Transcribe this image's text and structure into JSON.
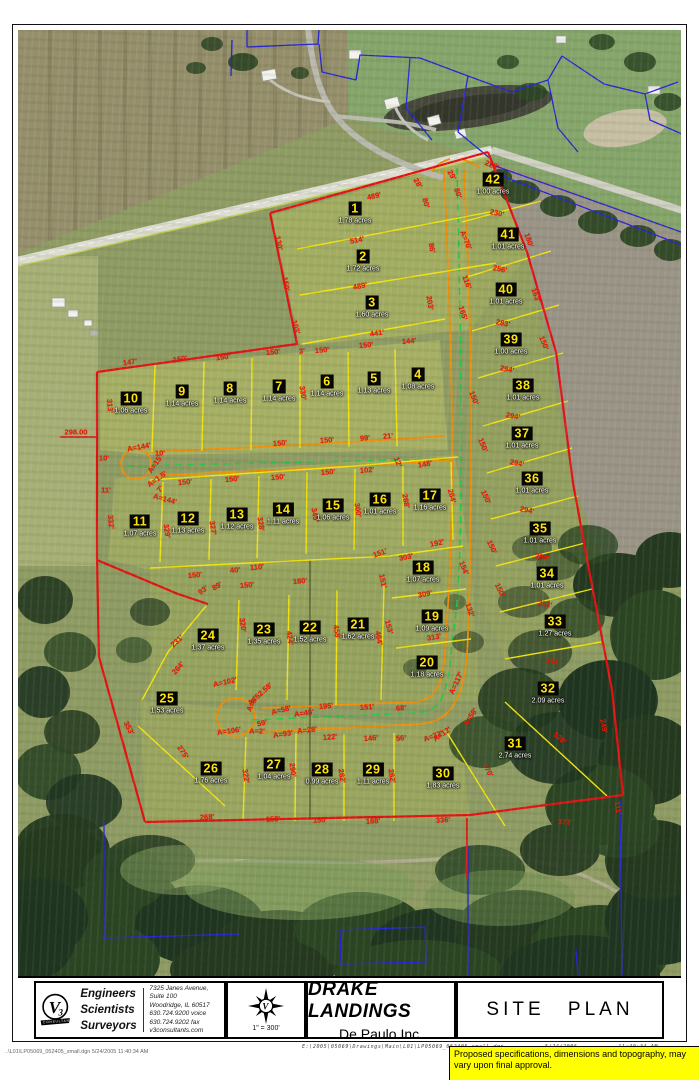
{
  "title_block": {
    "logo": {
      "letter": "V",
      "digit": "3",
      "banner": "CONSULTANTS"
    },
    "firm": {
      "roles": [
        "Engineers",
        "Scientists",
        "Surveyors"
      ],
      "address": [
        "7325 Janes Avenue, Suite 100",
        "Woodridge, IL 60517",
        "630.724.9200 voice",
        "630.724.9202 fax",
        "v3consultants.com"
      ]
    },
    "scale": "1\" = 300'",
    "project": "DRAKE LANDINGS",
    "client": "De Paulo Inc.",
    "sheet": "SITE PLAN",
    "file_path": "E:\\2005\\05069\\Drawings\\Main\\L01\\LP05069_052405_small.dgn",
    "date": "5/24/2005",
    "time": "11:40:34 AM"
  },
  "footer": {
    "left": "..\\L01\\LP05069_052405_small.dgn  5/24/2005 11:40:34 AM"
  },
  "note": {
    "text": "Proposed specifications, dimensions and topography, may vary upon final approval."
  },
  "map": {
    "colors": {
      "boundary": "#e51212",
      "lot_line": "#f2e30e",
      "street_edge": "#ef8f0a",
      "centerline": "#28c54a",
      "parcel_line": "#2626d8",
      "lot_badge_bg": "#050505",
      "lot_badge_fg": "#ffe40a",
      "dimension_text": "#ee1605",
      "note_bg": "#ffff00"
    },
    "lots": [
      {
        "n": 1,
        "acres": "1.78 acres",
        "x": 355,
        "y": 212
      },
      {
        "n": 2,
        "acres": "1.72 acres",
        "x": 363,
        "y": 260
      },
      {
        "n": 3,
        "acres": "1.60 acres",
        "x": 372,
        "y": 306
      },
      {
        "n": 4,
        "acres": "1.08 acres",
        "x": 418,
        "y": 378
      },
      {
        "n": 5,
        "acres": "1.13 acres",
        "x": 374,
        "y": 382
      },
      {
        "n": 6,
        "acres": "1.14 acres",
        "x": 327,
        "y": 385
      },
      {
        "n": 7,
        "acres": "1.14 acres",
        "x": 279,
        "y": 390
      },
      {
        "n": 8,
        "acres": "1.14 acres",
        "x": 230,
        "y": 392
      },
      {
        "n": 9,
        "acres": "1.14 acres",
        "x": 182,
        "y": 395
      },
      {
        "n": 10,
        "acres": "1.06 acres",
        "x": 131,
        "y": 402
      },
      {
        "n": 11,
        "acres": "1.07 acres",
        "x": 140,
        "y": 525
      },
      {
        "n": 12,
        "acres": "1.13 acres",
        "x": 188,
        "y": 522
      },
      {
        "n": 13,
        "acres": "1.12 acres",
        "x": 237,
        "y": 518
      },
      {
        "n": 14,
        "acres": "1.11 acres",
        "x": 283,
        "y": 513
      },
      {
        "n": 15,
        "acres": "1.06 acres",
        "x": 333,
        "y": 509
      },
      {
        "n": 16,
        "acres": "1.01 acres",
        "x": 380,
        "y": 503
      },
      {
        "n": 17,
        "acres": "1.16 acres",
        "x": 430,
        "y": 499
      },
      {
        "n": 18,
        "acres": "1.07 acres",
        "x": 423,
        "y": 571
      },
      {
        "n": 19,
        "acres": "1.09 acres",
        "x": 432,
        "y": 620
      },
      {
        "n": 20,
        "acres": "1.18 acres",
        "x": 427,
        "y": 666
      },
      {
        "n": 21,
        "acres": "1.62 acres",
        "x": 358,
        "y": 628
      },
      {
        "n": 22,
        "acres": "1.52 acres",
        "x": 310,
        "y": 631
      },
      {
        "n": 23,
        "acres": "1.35 acres",
        "x": 264,
        "y": 633
      },
      {
        "n": 24,
        "acres": "1.37 acres",
        "x": 208,
        "y": 639
      },
      {
        "n": 25,
        "acres": "1.53 acres",
        "x": 167,
        "y": 702
      },
      {
        "n": 26,
        "acres": "1.76 acres",
        "x": 211,
        "y": 772
      },
      {
        "n": 27,
        "acres": "1.04 acres",
        "x": 274,
        "y": 768
      },
      {
        "n": 28,
        "acres": "0.99 acres",
        "x": 322,
        "y": 773
      },
      {
        "n": 29,
        "acres": "1.11 acres",
        "x": 373,
        "y": 773
      },
      {
        "n": 30,
        "acres": "1.83 acres",
        "x": 443,
        "y": 777
      },
      {
        "n": 31,
        "acres": "2.74 acres",
        "x": 515,
        "y": 747
      },
      {
        "n": 32,
        "acres": "2.09 acres",
        "x": 548,
        "y": 692
      },
      {
        "n": 33,
        "acres": "1.27 acres",
        "x": 555,
        "y": 625
      },
      {
        "n": 34,
        "acres": "1.01 acres",
        "x": 547,
        "y": 577
      },
      {
        "n": 35,
        "acres": "1.01 acres",
        "x": 540,
        "y": 532
      },
      {
        "n": 36,
        "acres": "1.01 acres",
        "x": 532,
        "y": 482
      },
      {
        "n": 37,
        "acres": "1.01 acres",
        "x": 522,
        "y": 437
      },
      {
        "n": 38,
        "acres": "1.01 acres",
        "x": 523,
        "y": 389
      },
      {
        "n": 39,
        "acres": "1.00 acres",
        "x": 511,
        "y": 343
      },
      {
        "n": 40,
        "acres": "1.01 acres",
        "x": 506,
        "y": 293
      },
      {
        "n": 41,
        "acres": "1.01 acres",
        "x": 508,
        "y": 238
      },
      {
        "n": 42,
        "acres": "1.00 acres",
        "x": 493,
        "y": 183
      }
    ],
    "dimensions": [
      {
        "t": "489'",
        "x": 374,
        "y": 196,
        "r": -13
      },
      {
        "t": "514'",
        "x": 357,
        "y": 240,
        "r": -11
      },
      {
        "t": "489'",
        "x": 360,
        "y": 286,
        "r": -10
      },
      {
        "t": "441'",
        "x": 377,
        "y": 333,
        "r": -8
      },
      {
        "t": "228'",
        "x": 492,
        "y": 165,
        "r": 22
      },
      {
        "t": "230'",
        "x": 497,
        "y": 213,
        "r": 12
      },
      {
        "t": "256'",
        "x": 500,
        "y": 269,
        "r": 12
      },
      {
        "t": "283'",
        "x": 503,
        "y": 323,
        "r": 12
      },
      {
        "t": "28'",
        "x": 418,
        "y": 183,
        "r": 60
      },
      {
        "t": "80'",
        "x": 426,
        "y": 203,
        "r": 75
      },
      {
        "t": "29'",
        "x": 452,
        "y": 175,
        "r": 60
      },
      {
        "t": "80'",
        "x": 458,
        "y": 193,
        "r": 72
      },
      {
        "t": "130'",
        "x": 279,
        "y": 243,
        "r": 80
      },
      {
        "t": "150'",
        "x": 286,
        "y": 284,
        "r": 80
      },
      {
        "t": "103'",
        "x": 296,
        "y": 327,
        "r": 75
      },
      {
        "t": "86'",
        "x": 432,
        "y": 248,
        "r": 80
      },
      {
        "t": "203'",
        "x": 430,
        "y": 303,
        "r": 82
      },
      {
        "t": "A=70'",
        "x": 466,
        "y": 240,
        "r": 68
      },
      {
        "t": "116'",
        "x": 467,
        "y": 282,
        "r": 70
      },
      {
        "t": "165'",
        "x": 463,
        "y": 313,
        "r": 73
      },
      {
        "t": "180'",
        "x": 529,
        "y": 240,
        "r": 72
      },
      {
        "t": "163'",
        "x": 536,
        "y": 295,
        "r": 70
      },
      {
        "t": "150'",
        "x": 544,
        "y": 343,
        "r": 68
      },
      {
        "t": "147'",
        "x": 130,
        "y": 362,
        "r": -8
      },
      {
        "t": "150'",
        "x": 180,
        "y": 359,
        "r": -8
      },
      {
        "t": "150'",
        "x": 223,
        "y": 357,
        "r": -7
      },
      {
        "t": "150'",
        "x": 273,
        "y": 352,
        "r": -5
      },
      {
        "t": "3'",
        "x": 302,
        "y": 351,
        "r": -5
      },
      {
        "t": "150'",
        "x": 322,
        "y": 350,
        "r": -4
      },
      {
        "t": "150'",
        "x": 366,
        "y": 345,
        "r": -4
      },
      {
        "t": "144'",
        "x": 409,
        "y": 341,
        "r": -4
      },
      {
        "t": "330'",
        "x": 303,
        "y": 393,
        "r": 82
      },
      {
        "t": "298.00",
        "x": 76,
        "y": 432,
        "r": 0
      },
      {
        "t": "313'",
        "x": 110,
        "y": 406,
        "r": 85
      },
      {
        "t": "332'",
        "x": 111,
        "y": 522,
        "r": 85
      },
      {
        "t": "10'",
        "x": 104,
        "y": 458,
        "r": 0
      },
      {
        "t": "11'",
        "x": 106,
        "y": 490,
        "r": 0
      },
      {
        "t": "A=144'",
        "x": 139,
        "y": 447,
        "r": -10
      },
      {
        "t": "10'",
        "x": 160,
        "y": 453,
        "r": 0
      },
      {
        "t": "A=15'",
        "x": 155,
        "y": 464,
        "r": -55
      },
      {
        "t": "A=1.5'",
        "x": 157,
        "y": 479,
        "r": -35
      },
      {
        "t": "7'",
        "x": 160,
        "y": 489,
        "r": -50
      },
      {
        "t": "A=144'",
        "x": 165,
        "y": 499,
        "r": 15
      },
      {
        "t": "150'",
        "x": 280,
        "y": 443,
        "r": -4
      },
      {
        "t": "150'",
        "x": 327,
        "y": 440,
        "r": -4
      },
      {
        "t": "99'",
        "x": 365,
        "y": 438,
        "r": -4
      },
      {
        "t": "21'",
        "x": 388,
        "y": 436,
        "r": -4
      },
      {
        "t": "12'",
        "x": 398,
        "y": 462,
        "r": 70
      },
      {
        "t": "150'",
        "x": 185,
        "y": 482,
        "r": -5
      },
      {
        "t": "150'",
        "x": 232,
        "y": 479,
        "r": -5
      },
      {
        "t": "150'",
        "x": 278,
        "y": 477,
        "r": -4
      },
      {
        "t": "150'",
        "x": 328,
        "y": 472,
        "r": -4
      },
      {
        "t": "102'",
        "x": 367,
        "y": 470,
        "r": -4
      },
      {
        "t": "148'",
        "x": 425,
        "y": 464,
        "r": -10
      },
      {
        "t": "329'",
        "x": 167,
        "y": 531,
        "r": 82
      },
      {
        "t": "327'",
        "x": 213,
        "y": 528,
        "r": 82
      },
      {
        "t": "328'",
        "x": 261,
        "y": 524,
        "r": 82
      },
      {
        "t": "345'",
        "x": 315,
        "y": 515,
        "r": 82
      },
      {
        "t": "300'",
        "x": 358,
        "y": 510,
        "r": 82
      },
      {
        "t": "288'",
        "x": 406,
        "y": 501,
        "r": 80
      },
      {
        "t": "264'",
        "x": 452,
        "y": 496,
        "r": 75
      },
      {
        "t": "150'",
        "x": 195,
        "y": 575,
        "r": -5
      },
      {
        "t": "40'",
        "x": 235,
        "y": 570,
        "r": -5
      },
      {
        "t": "110'",
        "x": 257,
        "y": 567,
        "r": -5
      },
      {
        "t": "150'",
        "x": 247,
        "y": 585,
        "r": -5
      },
      {
        "t": "180'",
        "x": 300,
        "y": 581,
        "r": -5
      },
      {
        "t": "151'",
        "x": 380,
        "y": 553,
        "r": -20
      },
      {
        "t": "303'",
        "x": 406,
        "y": 557,
        "r": -12
      },
      {
        "t": "192'",
        "x": 437,
        "y": 543,
        "r": -12
      },
      {
        "t": "151'",
        "x": 383,
        "y": 581,
        "r": 78
      },
      {
        "t": "309'",
        "x": 425,
        "y": 594,
        "r": -10
      },
      {
        "t": "153'",
        "x": 389,
        "y": 627,
        "r": 75
      },
      {
        "t": "313'",
        "x": 434,
        "y": 637,
        "r": -10
      },
      {
        "t": "154'",
        "x": 464,
        "y": 568,
        "r": 68
      },
      {
        "t": "132'",
        "x": 470,
        "y": 610,
        "r": 72
      },
      {
        "t": "150'",
        "x": 492,
        "y": 547,
        "r": 65
      },
      {
        "t": "294'",
        "x": 507,
        "y": 369,
        "r": 11
      },
      {
        "t": "294'",
        "x": 513,
        "y": 416,
        "r": 11
      },
      {
        "t": "294'",
        "x": 517,
        "y": 463,
        "r": 11
      },
      {
        "t": "294'",
        "x": 527,
        "y": 510,
        "r": 11
      },
      {
        "t": "294'",
        "x": 542,
        "y": 557,
        "r": 11
      },
      {
        "t": "294'",
        "x": 545,
        "y": 604,
        "r": 11
      },
      {
        "t": "344'",
        "x": 553,
        "y": 661,
        "r": 11
      },
      {
        "t": "150'",
        "x": 474,
        "y": 398,
        "r": 68
      },
      {
        "t": "150'",
        "x": 483,
        "y": 445,
        "r": 68
      },
      {
        "t": "150'",
        "x": 486,
        "y": 497,
        "r": 66
      },
      {
        "t": "150'",
        "x": 500,
        "y": 590,
        "r": 64
      },
      {
        "t": "320'",
        "x": 243,
        "y": 625,
        "r": 82
      },
      {
        "t": "424'",
        "x": 290,
        "y": 638,
        "r": 82
      },
      {
        "t": "458'",
        "x": 337,
        "y": 632,
        "r": 82
      },
      {
        "t": "464'",
        "x": 379,
        "y": 638,
        "r": 80
      },
      {
        "t": "89'",
        "x": 217,
        "y": 586,
        "r": -30
      },
      {
        "t": "93'",
        "x": 203,
        "y": 590,
        "r": -35
      },
      {
        "t": "231'",
        "x": 177,
        "y": 641,
        "r": -42
      },
      {
        "t": "264'",
        "x": 178,
        "y": 668,
        "r": -48
      },
      {
        "t": "A=102'",
        "x": 225,
        "y": 682,
        "r": -12
      },
      {
        "t": "A=52.59'",
        "x": 260,
        "y": 694,
        "r": -42
      },
      {
        "t": "A=5'",
        "x": 252,
        "y": 704,
        "r": -62
      },
      {
        "t": "A=58'",
        "x": 281,
        "y": 710,
        "r": -14
      },
      {
        "t": "A=46'",
        "x": 304,
        "y": 713,
        "r": -8
      },
      {
        "t": "195'",
        "x": 326,
        "y": 706,
        "r": -5
      },
      {
        "t": "151'",
        "x": 367,
        "y": 707,
        "r": -4
      },
      {
        "t": "68'",
        "x": 401,
        "y": 708,
        "r": -4
      },
      {
        "t": "59'",
        "x": 262,
        "y": 723,
        "r": -10
      },
      {
        "t": "A=106'",
        "x": 229,
        "y": 731,
        "r": -8
      },
      {
        "t": "A=2'",
        "x": 257,
        "y": 731,
        "r": 0
      },
      {
        "t": "A=93'",
        "x": 283,
        "y": 734,
        "r": -8
      },
      {
        "t": "A=28'",
        "x": 307,
        "y": 730,
        "r": -6
      },
      {
        "t": "122'",
        "x": 330,
        "y": 737,
        "r": -4
      },
      {
        "t": "146'",
        "x": 371,
        "y": 738,
        "r": -4
      },
      {
        "t": "56'",
        "x": 401,
        "y": 738,
        "r": -4
      },
      {
        "t": "A=12'",
        "x": 442,
        "y": 734,
        "r": -35
      },
      {
        "t": "353'",
        "x": 129,
        "y": 728,
        "r": 63
      },
      {
        "t": "275'",
        "x": 183,
        "y": 752,
        "r": 56
      },
      {
        "t": "322'",
        "x": 246,
        "y": 776,
        "r": 82
      },
      {
        "t": "290'",
        "x": 293,
        "y": 770,
        "r": 82
      },
      {
        "t": "282'",
        "x": 342,
        "y": 776,
        "r": 82
      },
      {
        "t": "282'",
        "x": 392,
        "y": 776,
        "r": 82
      },
      {
        "t": "268'",
        "x": 207,
        "y": 817,
        "r": -3
      },
      {
        "t": "150'",
        "x": 273,
        "y": 819,
        "r": -3
      },
      {
        "t": "150'",
        "x": 320,
        "y": 820,
        "r": -3
      },
      {
        "t": "188'",
        "x": 373,
        "y": 821,
        "r": -3
      },
      {
        "t": "336'",
        "x": 443,
        "y": 820,
        "r": -3
      },
      {
        "t": "A=117'",
        "x": 456,
        "y": 683,
        "r": -65
      },
      {
        "t": "A=58'",
        "x": 470,
        "y": 717,
        "r": -55
      },
      {
        "t": "A=32'",
        "x": 433,
        "y": 736,
        "r": -20
      },
      {
        "t": "370'",
        "x": 488,
        "y": 770,
        "r": 62
      },
      {
        "t": "528'",
        "x": 560,
        "y": 738,
        "r": 42
      },
      {
        "t": "249'",
        "x": 604,
        "y": 726,
        "r": 78
      },
      {
        "t": "111'",
        "x": 618,
        "y": 808,
        "r": 82
      },
      {
        "t": "373'",
        "x": 565,
        "y": 822,
        "r": 3
      }
    ]
  }
}
